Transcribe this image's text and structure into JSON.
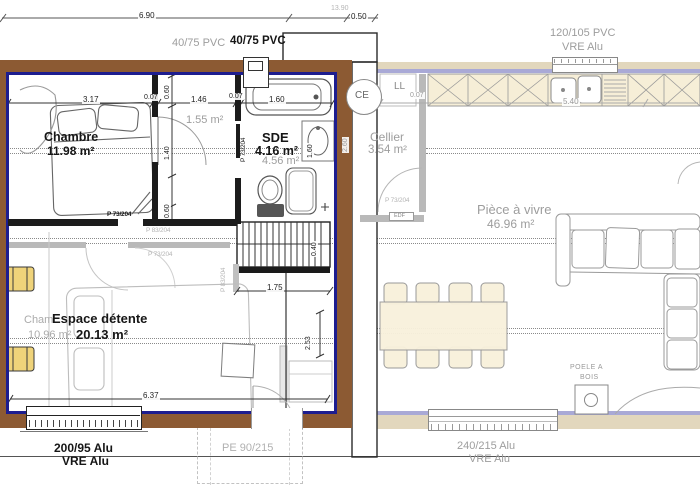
{
  "top": {
    "dim_total": "6.90",
    "dim_overall": "13.90",
    "dim_offset": "0.50",
    "flue_old": "40/75 PVC",
    "flue_new": "40/75 PVC",
    "window_line1": "120/105 PVC",
    "window_line2": "VRE Alu"
  },
  "rooms": {
    "chambre": {
      "name": "Chambre",
      "area": "11.98 m²"
    },
    "closet_old_area": "1.55 m²",
    "sde": {
      "name": "SDE",
      "area": "4.16 m²",
      "old_area": "4.56 m²"
    },
    "cellier": {
      "name": "Cellier",
      "area": "3.54 m²"
    },
    "living": {
      "name": "Pièce à vivre",
      "area": "46.96 m²"
    },
    "espace": {
      "name": "Espace détente",
      "area": "20.13 m²",
      "old_name": "Cham",
      "old_area": "10.96 m²"
    }
  },
  "equipment": {
    "water_heater": "CE",
    "washing_machine": "LL",
    "electric_panel": "EDF",
    "stove_line1": "POELE A",
    "stove_line2": "BOIS"
  },
  "doors": {
    "espace_top": "P 73/204",
    "old_door_1": "P 83/204",
    "old_door_2": "P 73/204",
    "sde_door": "P 73/204",
    "stairs_door": "P 83/204",
    "cellier_door": "P 73/204",
    "entry_door": "PE 90/215"
  },
  "windows": {
    "bottom_left_line1": "200/95 Alu",
    "bottom_left_line2": "VRE Alu",
    "bottom_right_line1": "240/215 Alu",
    "bottom_right_line2": "VRE Alu"
  },
  "dims": {
    "bed_wall": "3.17",
    "wall_a": "0.07",
    "hall": "1.46",
    "wall_b": "0.07",
    "bath": "1.60",
    "v_top": "0.60",
    "v_mid": "1.40",
    "v_bot": "0.60",
    "sde_width": "1.60",
    "duct": "2.60",
    "cellier_wall": "0.07",
    "kitchen_run": "5.40",
    "stair_width": "1.75",
    "stair_depth": "0.40",
    "espace_depth": "2.53",
    "inner_width": "6.37"
  },
  "colors": {
    "new_wall": "#8c5a33",
    "frame": "#1d1d8f",
    "existing_wall": "#a9a9d6",
    "cabinet": "#f6eed7",
    "accent_chair": "#efd37a"
  }
}
